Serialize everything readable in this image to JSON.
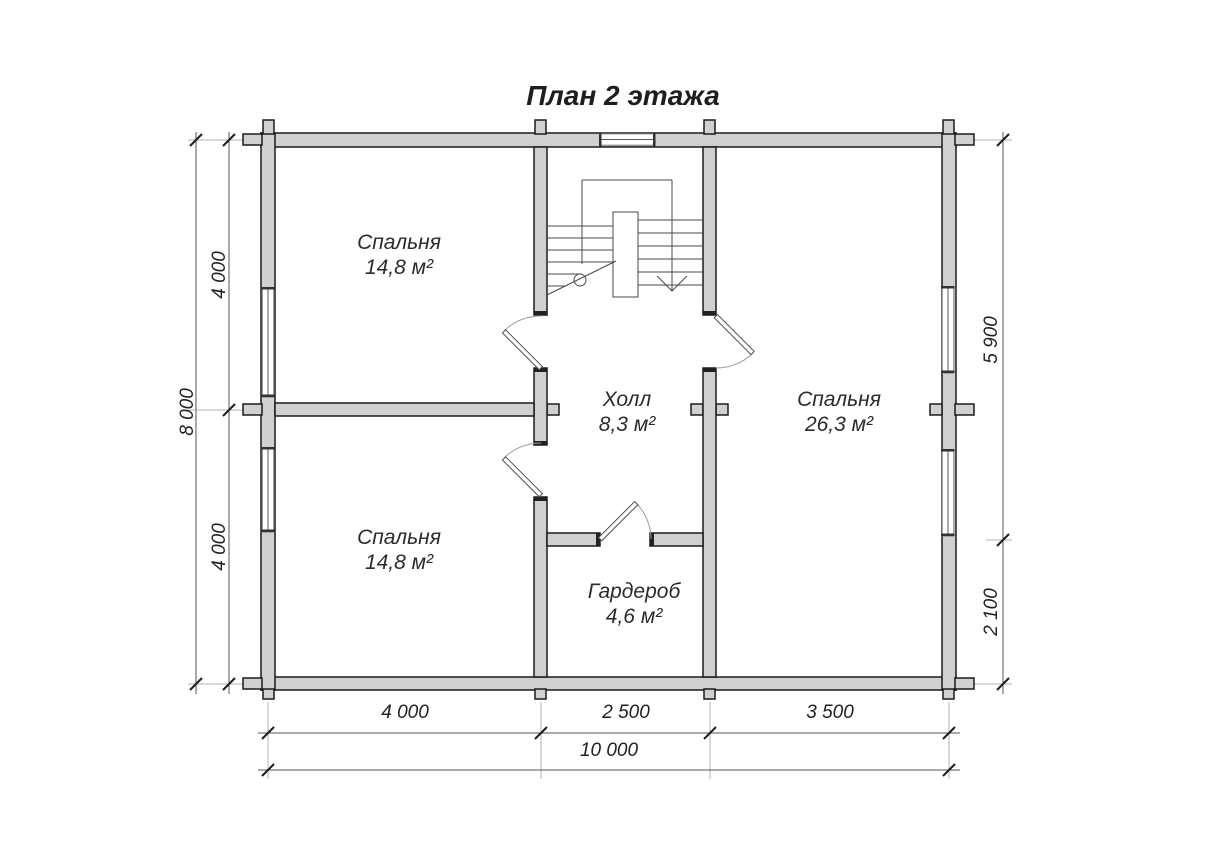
{
  "title": "План 2 этажа",
  "rooms": [
    {
      "id": "bedroom-top-left",
      "name": "Спальня",
      "area": "14,8 м²"
    },
    {
      "id": "bedroom-bottom-left",
      "name": "Спальня",
      "area": "14,8 м²"
    },
    {
      "id": "hall",
      "name": "Холл",
      "area": "8,3 м²"
    },
    {
      "id": "bedroom-right",
      "name": "Спальня",
      "area": "26,3 м²"
    },
    {
      "id": "wardrobe",
      "name": "Гардероб",
      "area": "4,6 м²"
    }
  ],
  "dimensions": {
    "left_total": "8 000",
    "left_upper": "4 000",
    "left_lower": "4 000",
    "right_upper": "5 900",
    "right_lower": "2 100",
    "bottom_segments": [
      "4 000",
      "2 500",
      "3 500"
    ],
    "bottom_total": "10 000"
  },
  "colors": {
    "background": "#ffffff",
    "wall_fill": "#d0d0d0",
    "wall_stroke": "#1b1b1b",
    "thin_line": "#4a4a4a",
    "text": "#2b2b2b"
  }
}
